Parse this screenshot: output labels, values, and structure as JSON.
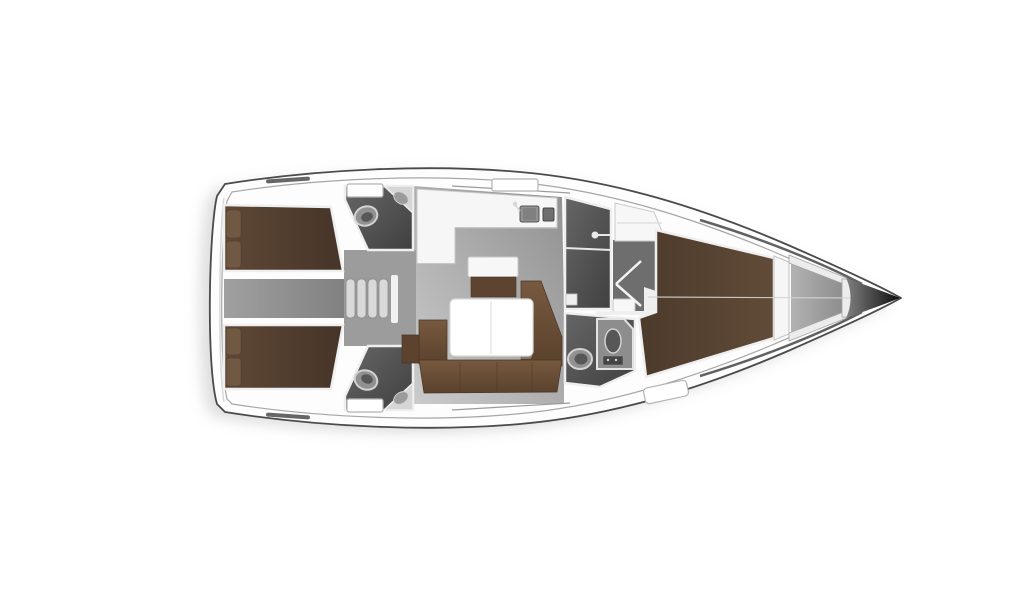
{
  "canvas": {
    "background": "#ffffff"
  },
  "layout": {
    "vessel": "sailing-yacht-floor-plan",
    "orientation": "bow-right",
    "rooms": [
      "aft-cabin-port",
      "aft-cabin-starboard",
      "aft-head-port",
      "aft-head-starboard",
      "companionway",
      "saloon",
      "galley",
      "dinette",
      "forward-shower",
      "forward-head",
      "forward-passage",
      "forward-cabin",
      "anchor-locker",
      "bow"
    ]
  },
  "colors": {
    "shadow": "#c2c2c2",
    "hull_fill": "#fdfdfd",
    "hull_outline": "#4a4a4a",
    "hull_inner_line": "#a6a6a6",
    "bow_edge": "#3a3a3a",
    "transom_line": "#d8d8d8",
    "saloon_floor_light": "#cbcbcb",
    "saloon_floor_dark": "#909090",
    "midzone_gray": "#a3a3a3",
    "zone_gray": "#9c9c9c",
    "corridor_light": "#a0a0a0",
    "corridor_dark": "#808080",
    "bed_aft_light": "#5f4836",
    "bed_aft_dark": "#453428",
    "bed_fwd_light": "#614b38",
    "bed_fwd_dark": "#4c3a2b",
    "pillow": "#705842",
    "pillow_stroke": "#4e3a2b",
    "sofa_light": "#77593f",
    "sofa_dark": "#5a422d",
    "sofa_stroke": "#4a3524",
    "sofa_cap": "#5c432f",
    "cabinet_front": "#5d4430",
    "counter_white": "#f6f6f6",
    "counter_stroke": "#c9c9c9",
    "counter_edge": "#b5b5b5",
    "table_white": "#ffffff",
    "table_stroke": "#dadada",
    "table_seam": "#e7e7e7",
    "table_shadow": "#ababab",
    "head_light": "#666666",
    "head_dark": "#404040",
    "wall_white": "#efefef",
    "wall_stroke": "#c4c4c4",
    "fixture_light": "#d6d6d6",
    "fixture_mid": "#8f8f8f",
    "fixture_dark": "#555555",
    "basin_gray": "#9b9b9b",
    "toilet_fill": "#919191",
    "toilet_inner": "#575757",
    "toilet_stroke": "#d2d2d2",
    "passage_gray": "#6e6e6e",
    "door_line": "#f2f2f2",
    "step_tread": "#d9d9d9",
    "step_stroke": "#8d8d8d",
    "step_back": "#9a9a9a",
    "threshold": "#f1f1f1",
    "shelf_white": "#f7f7f7",
    "shelf_line": "#dcdcdc",
    "hatch_fill": "#ffffff",
    "hatch_stroke": "#b3b3b3",
    "locker_light": "#b2b2b2",
    "locker_dark": "#8b8b8b",
    "locker_wall": "#ececec",
    "locker_wall_stroke": "#a5a5a5",
    "headboard": "#f6f6f6",
    "bow_light": "#808080",
    "bow_dark": "#0e0e0e",
    "centerline": "#d4d4d4",
    "deck_strip": "#666666",
    "rail_line": "#9b9b9b",
    "shower_chrome": "#e8e8e8",
    "sinkunit_fill": "#8d8d8d",
    "sinkunit_stroke": "#e3e3e3",
    "detail_dark": "#454545"
  }
}
